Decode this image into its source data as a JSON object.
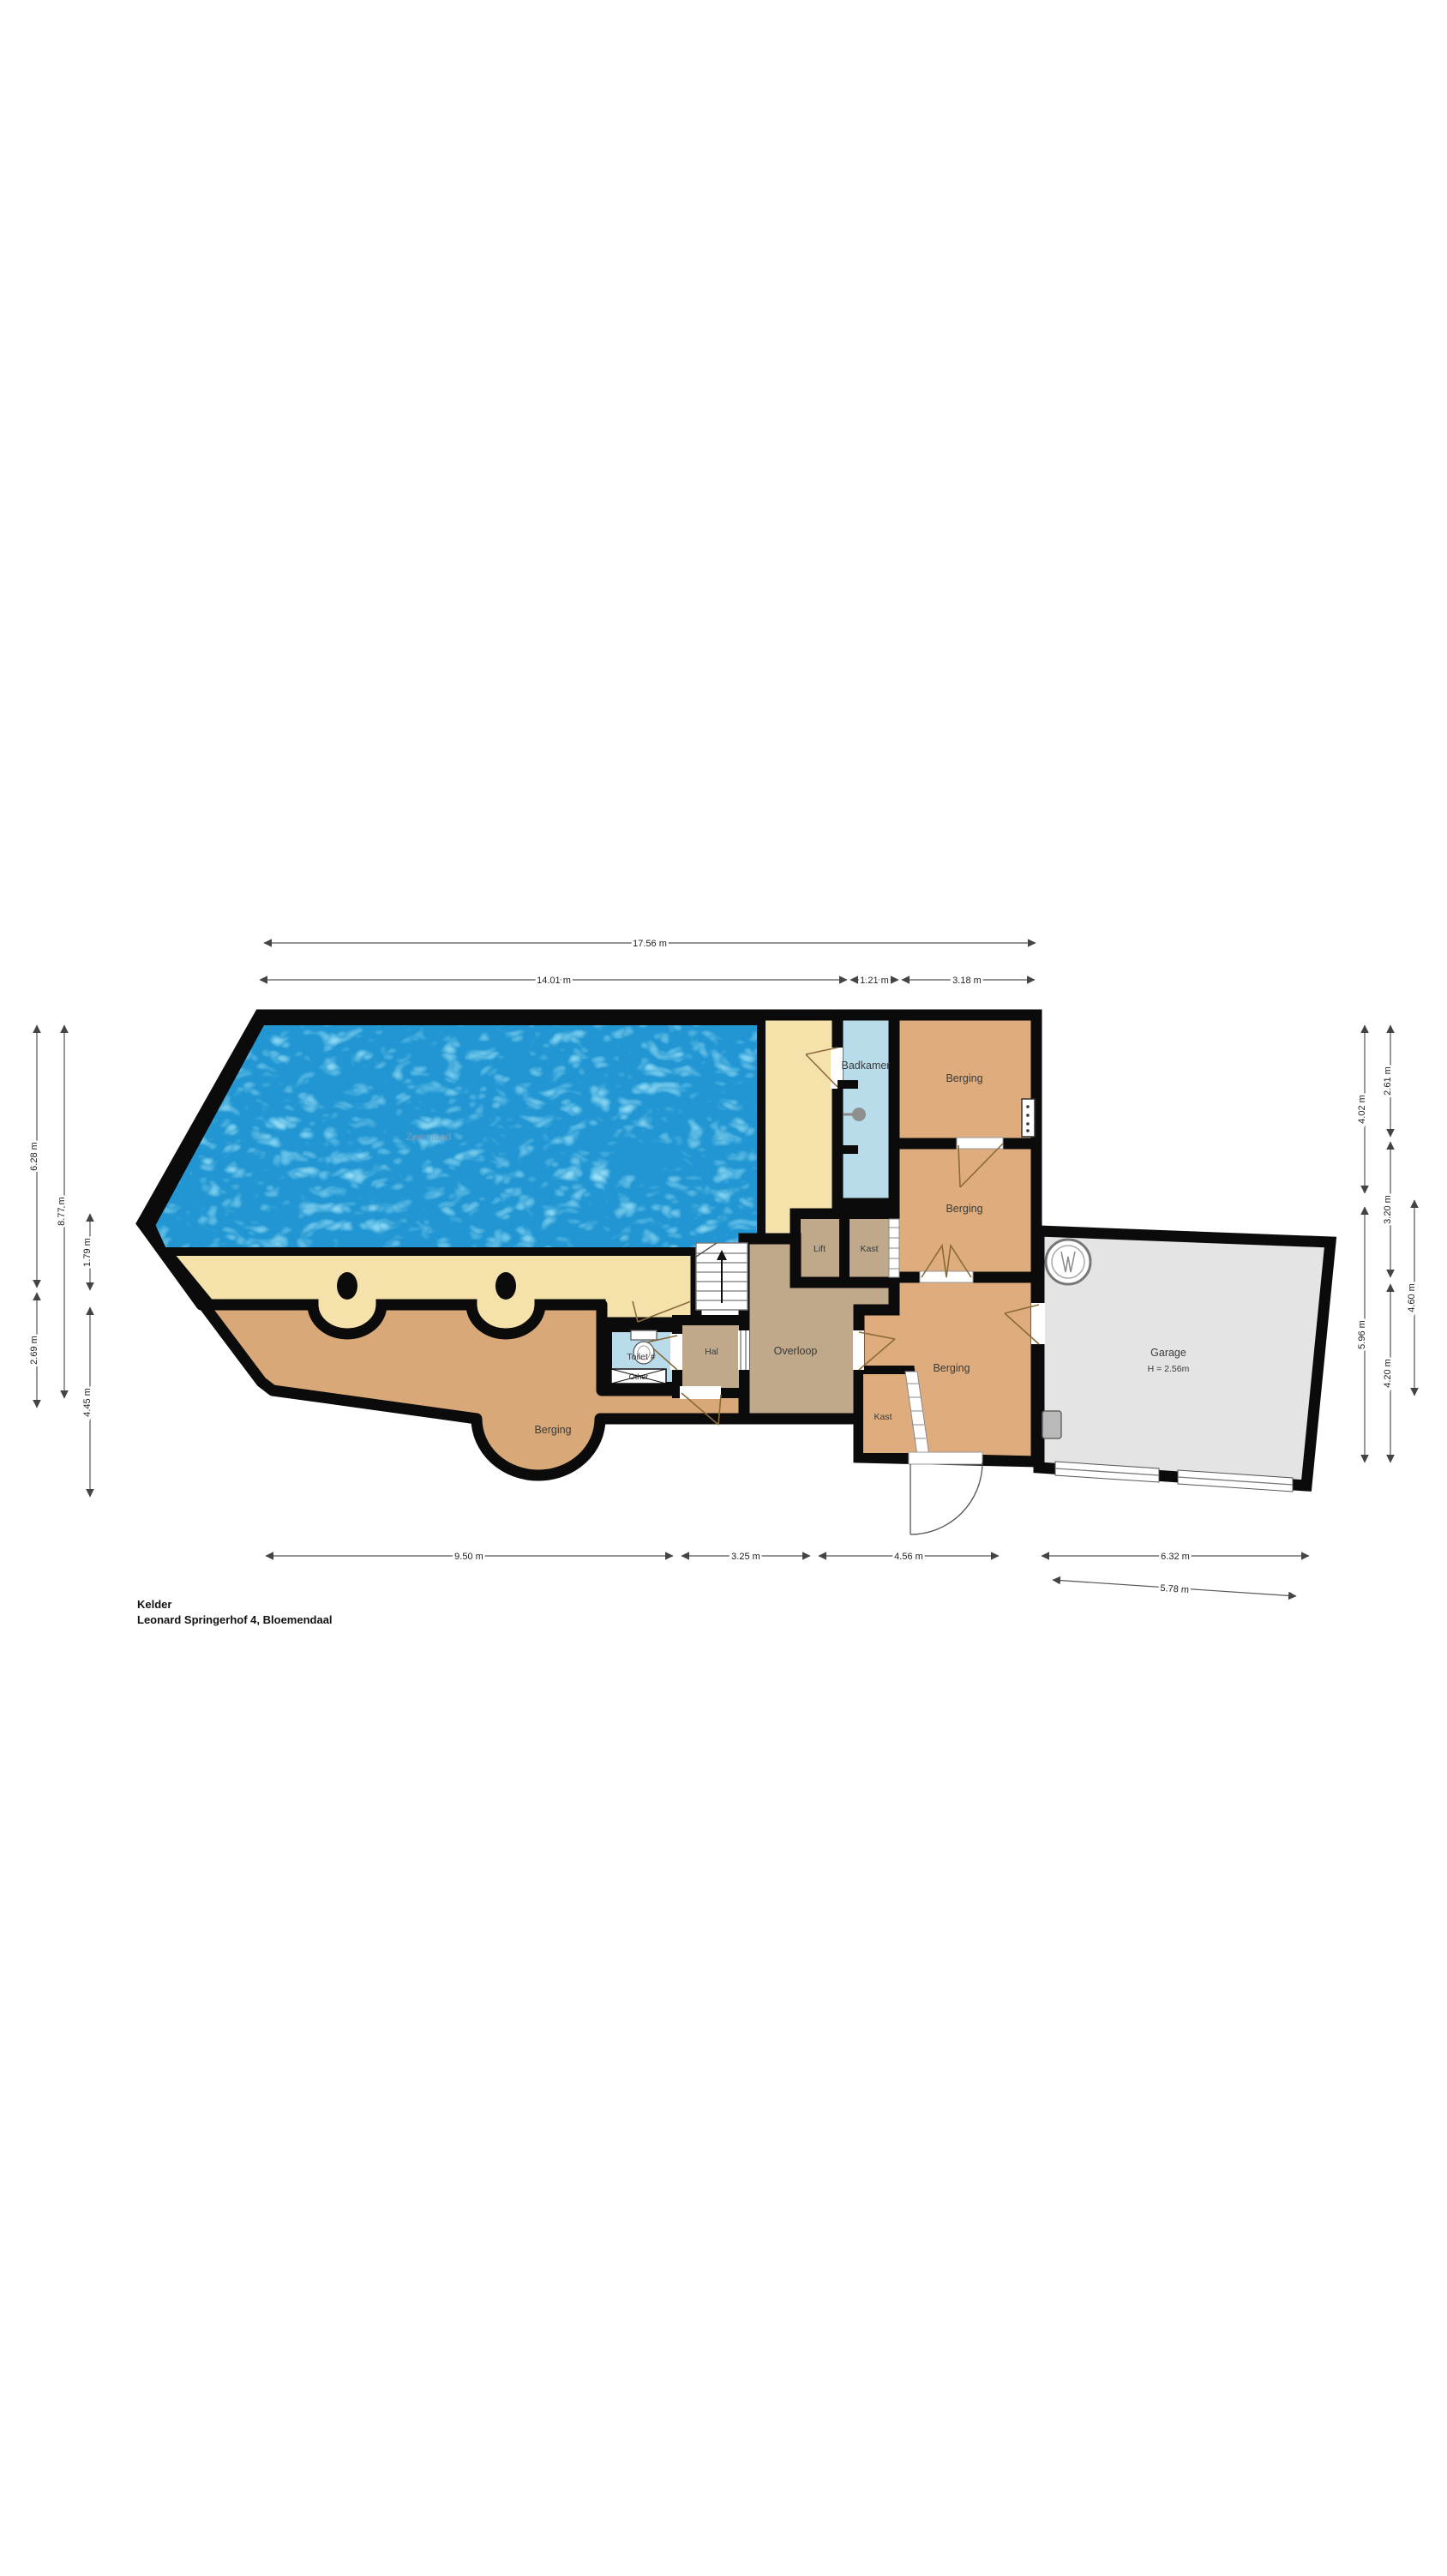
{
  "plan": {
    "title": "Kelder",
    "subtitle": "Leonard Springerhof 4, Bloemendaal",
    "rooms": {
      "zwembad": "Zwembad",
      "badkamer": "Badkamer",
      "berging_top": "Berging",
      "berging_mid": "Berging",
      "berging_bottom": "Berging",
      "berging_left": "Berging",
      "lift": "Lift",
      "kast_top": "Kast",
      "kast_bottom": "Kast",
      "overloop": "Overloop",
      "hal": "Hal",
      "toilet": "Toilet #",
      "garage": "Garage"
    },
    "annotations": {
      "garage_height": "H = 2.56m",
      "fixture_box": "Other"
    },
    "dimensions": {
      "top_total": "17.56 m",
      "top_1": "14.01 m",
      "top_2": "1.21 m",
      "top_3": "3.18 m",
      "left_outer_1": "6.28 m",
      "left_outer_2": "2.69 m",
      "left_mid": "8.77 m",
      "left_inner_1": "1.79 m",
      "left_inner_2": "4.45 m",
      "right_inner_1": "4.02 m",
      "right_inner_2": "5.96 m",
      "right_mid_1": "2.61 m",
      "right_mid_2": "3.20 m",
      "right_mid_3": "4.20 m",
      "right_outer": "4.60 m",
      "bottom_1": "9.50 m",
      "bottom_2": "3.25 m",
      "bottom_3": "4.56 m",
      "bottom_4": "6.32 m",
      "bottom_slanted": "5.78 m"
    },
    "colors": {
      "wall": "#0b0b0b",
      "floor_cream": "#f5e2ab",
      "floor_orange": "#dfac7d",
      "floor_taupe": "#bfa98a",
      "floor_blue": "#b9dcea",
      "floor_garage": "#e4e4e4",
      "pool_water": "#2196d2"
    }
  }
}
